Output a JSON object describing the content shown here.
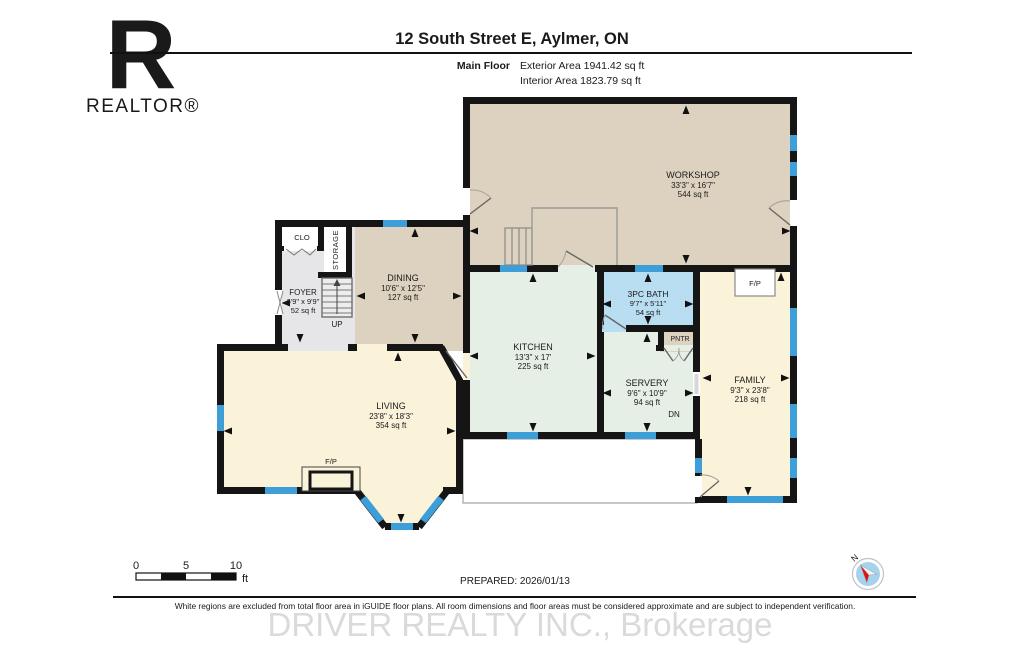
{
  "header": {
    "title": "12 South Street E, Aylmer, ON",
    "floor_label": "Main Floor",
    "exterior_area": "Exterior Area 1941.42 sq ft",
    "interior_area": "Interior Area 1823.79 sq ft"
  },
  "branding": {
    "realtor_logo_letter": "R",
    "realtor_logo_text": "REALTOR®",
    "watermark": "DRIVER REALTY INC., Brokerage"
  },
  "rooms": {
    "workshop": {
      "name": "WORKSHOP",
      "dims": "33'3\" x 16'7\"",
      "area": "544 sq ft"
    },
    "dining": {
      "name": "DINING",
      "dims": "10'6\" x 12'5\"",
      "area": "127 sq ft"
    },
    "foyer": {
      "name": "FOYER",
      "dims": "6'9\" x 9'9\"",
      "area": "52 sq ft"
    },
    "kitchen": {
      "name": "KITCHEN",
      "dims": "13'3\" x 17'",
      "area": "225 sq ft"
    },
    "bath": {
      "name": "3PC BATH",
      "dims": "9'7\" x 5'11\"",
      "area": "54 sq ft"
    },
    "servery": {
      "name": "SERVERY",
      "dims": "9'6\" x 10'9\"",
      "area": "94 sq ft"
    },
    "family": {
      "name": "FAMILY",
      "dims": "9'3\" x 23'8\"",
      "area": "218 sq ft"
    },
    "living": {
      "name": "LIVING",
      "dims": "23'8\" x 18'3\"",
      "area": "354 sq ft"
    }
  },
  "labels": {
    "clo": "CLO",
    "storage": "STORAGE",
    "pntr": "PNTR",
    "up": "UP",
    "dn": "DN",
    "fireplace": "F/P"
  },
  "scale_bar": {
    "tick0": "0",
    "tick5": "5",
    "tick10": "10",
    "unit": "ft"
  },
  "compass": {
    "north_label": "N"
  },
  "footer": {
    "prepared": "PREPARED: 2026/01/13",
    "disclaimer": "White regions are excluded from total floor area in iGUIDE floor plans. All room dimensions and floor areas must be considered approximate and are subject to independent verification."
  },
  "colors": {
    "wall": "#151515",
    "window": "#3d9ed8",
    "workshop_floor": "#ddd2c0",
    "kitchen_floor": "#e5efe6",
    "bath_floor": "#b9ddf1",
    "living_floor": "#faf3da",
    "foyer_floor": "#e6e6e8"
  }
}
